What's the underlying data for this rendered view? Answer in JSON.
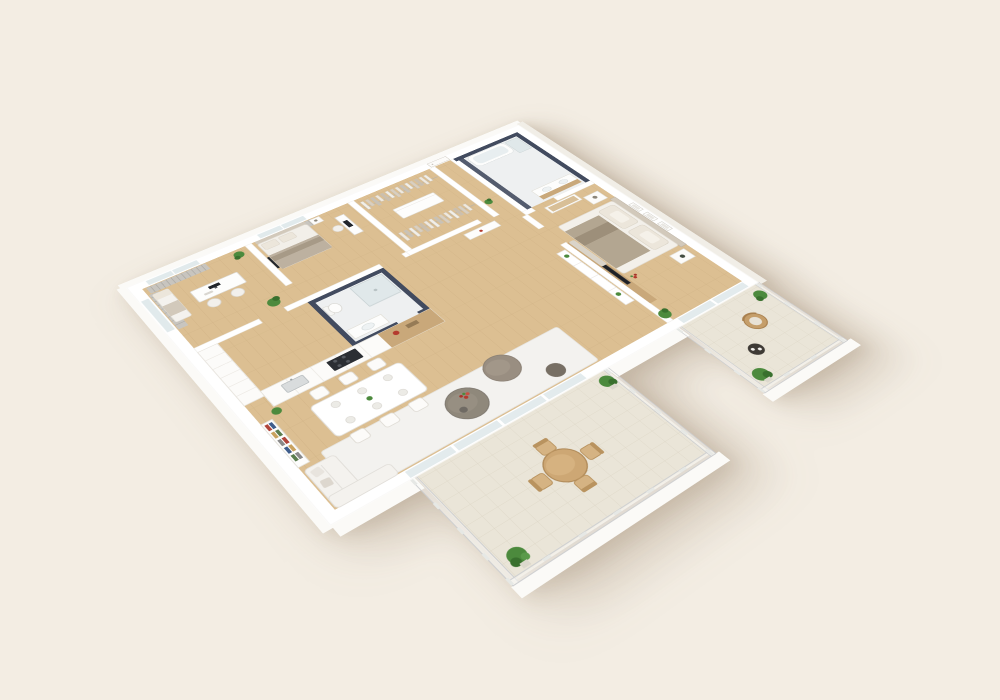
{
  "scene": {
    "description": "3D isometric cutaway rendering of an apartment floor plan on a cream background",
    "background": "#f3ede3",
    "palette": {
      "bg": "#f3ede3",
      "wall": "#ffffff",
      "wallEdge": "#e6e2d9",
      "apron": "#fbfaf7",
      "apronShade": "#f1eee7",
      "wood": "#dcbf92",
      "woodLine": "#cbad7f",
      "navy": "#424b5f",
      "bathTile": "#eef0f1",
      "tile": "#eae5d8",
      "tileLine": "#d8d1c0",
      "rug": "#f3f2ef",
      "sofa": "#f4f2ee",
      "gray1": "#8f887b",
      "gray2": "#998e81",
      "gray3": "#776f64",
      "bedding": "#b3a691",
      "beddingDark": "#9d8f7a",
      "pillow": "#ece6db",
      "headboard": "#d2c9bb",
      "woodAccent": "#c9a87a",
      "tan": "#d5b383",
      "tanDark": "#b9935f",
      "plant": "#4c8a3d",
      "plantDark": "#39702e",
      "glass": "#e1eaec",
      "glassFrame": "#ffffff",
      "railing": "#ccced0",
      "railGlass": "rgba(250,250,248,0.55)",
      "metal": "#c6cbcd",
      "dark": "#22262c",
      "red": "#b43a2e",
      "white2": "#fcfbf9",
      "furnLine": "#e2dfd8"
    },
    "rooms": [
      {
        "id": "office",
        "objects": [
          "daybed",
          "desk",
          "monitor",
          "chairs",
          "plants",
          "window",
          "curtains"
        ]
      },
      {
        "id": "bedroom-2",
        "objects": [
          "bed",
          "pillows",
          "nightstand",
          "wall-tv",
          "desk",
          "chair",
          "window",
          "curtains"
        ]
      },
      {
        "id": "walk-in-closet",
        "objects": [
          "hanging-rail-north",
          "hanging-rail-south",
          "island-dresser"
        ]
      },
      {
        "id": "entry-hall",
        "objects": [
          "entry-door",
          "plant"
        ]
      },
      {
        "id": "master-bathroom",
        "objects": [
          "bathtub",
          "shower",
          "double-vanity",
          "navy-walls"
        ]
      },
      {
        "id": "small-bathroom",
        "objects": [
          "shower",
          "toilet",
          "vanity",
          "navy-walls"
        ]
      },
      {
        "id": "kitchen",
        "objects": [
          "tall-cabinets",
          "counter",
          "sink",
          "cooktop",
          "wood-counter",
          "red-pot"
        ]
      },
      {
        "id": "dining",
        "objects": [
          "table",
          "six-chairs",
          "place-settings"
        ]
      },
      {
        "id": "living-room",
        "objects": [
          "bookshelf",
          "sofa",
          "rug",
          "coffee-table",
          "flowers",
          "ottoman-pouf",
          "stool",
          "sliding-glass-door"
        ]
      },
      {
        "id": "hallway",
        "objects": [
          "console-shelf",
          "media-wall",
          "tv",
          "plants"
        ]
      },
      {
        "id": "master-bedroom",
        "objects": [
          "double-bed",
          "headboard",
          "pillows",
          "nightstands",
          "dresser",
          "bench",
          "wall-frames",
          "plant",
          "sliding-glass-door"
        ]
      },
      {
        "id": "main-balcony",
        "objects": [
          "tile-floor",
          "glass-railing",
          "round-table",
          "four-chairs",
          "potted-plants"
        ]
      },
      {
        "id": "master-balcony",
        "objects": [
          "tile-floor",
          "glass-railing",
          "wicker-chair",
          "side-table",
          "cups",
          "potted-plants"
        ]
      }
    ]
  }
}
